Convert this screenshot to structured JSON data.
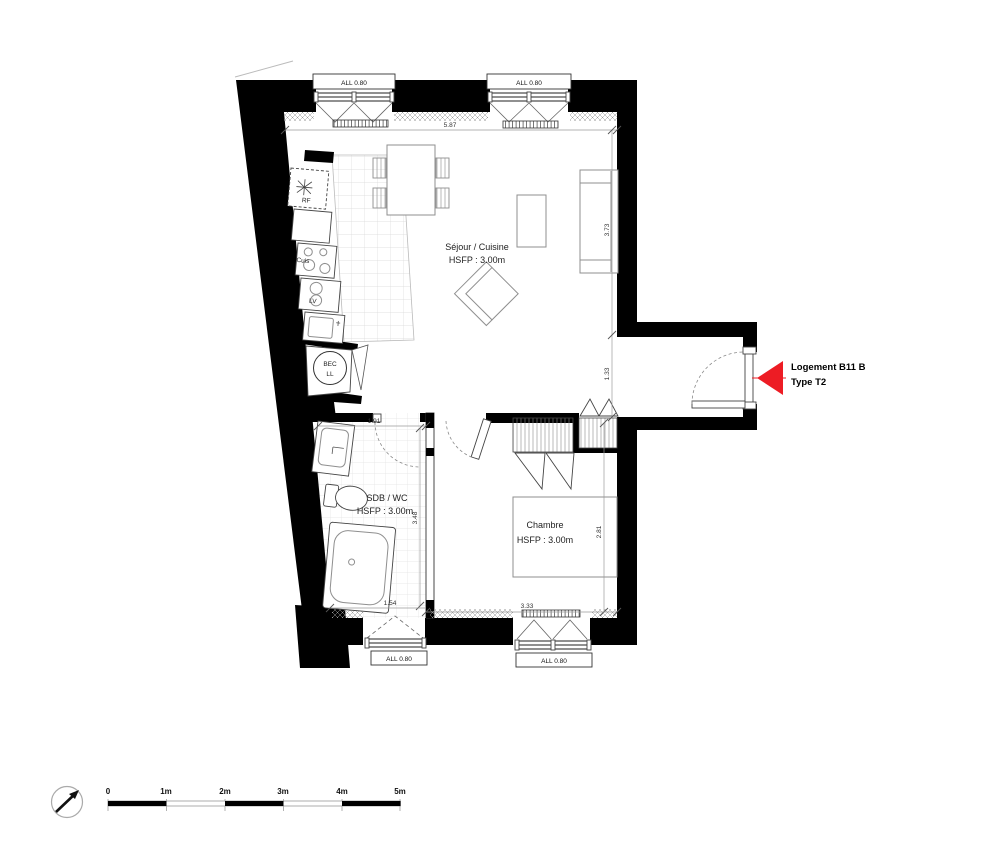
{
  "annotation": {
    "line1": "Logement B11 B",
    "line2": "Type T2"
  },
  "rooms": {
    "sejour": {
      "name": "Séjour / Cuisine",
      "ceiling": "HSFP : 3.00m"
    },
    "sdb": {
      "name": "SDB / WC",
      "ceiling": "HSFP : 3.00m"
    },
    "chambre": {
      "name": "Chambre",
      "ceiling": "HSFP : 3.00m"
    }
  },
  "fixtures": {
    "fridge": "RF",
    "cooktop": "Cuis",
    "dishwasher": "LV",
    "laundry_line1": "BEC",
    "laundry_line2": "LL"
  },
  "windows": {
    "top_left": "ALL 0.80",
    "top_right": "ALL 0.80",
    "bottom_left": "ALL 0.80",
    "bottom_right": "ALL 0.80"
  },
  "dimensions": {
    "top_width": "5.87",
    "sejour_height": "3.73",
    "entry_height": "1.33",
    "sdb_width_top": "1.91",
    "sdb_height": "3.48",
    "sdb_width_bottom": "1.54",
    "chambre_width": "3.33",
    "chambre_height": "2.81"
  },
  "scale_bar": {
    "labels": [
      "0",
      "1m",
      "2m",
      "3m",
      "4m",
      "5m"
    ]
  },
  "colors": {
    "wall": "#000000",
    "arrow": "#ed1c24"
  }
}
